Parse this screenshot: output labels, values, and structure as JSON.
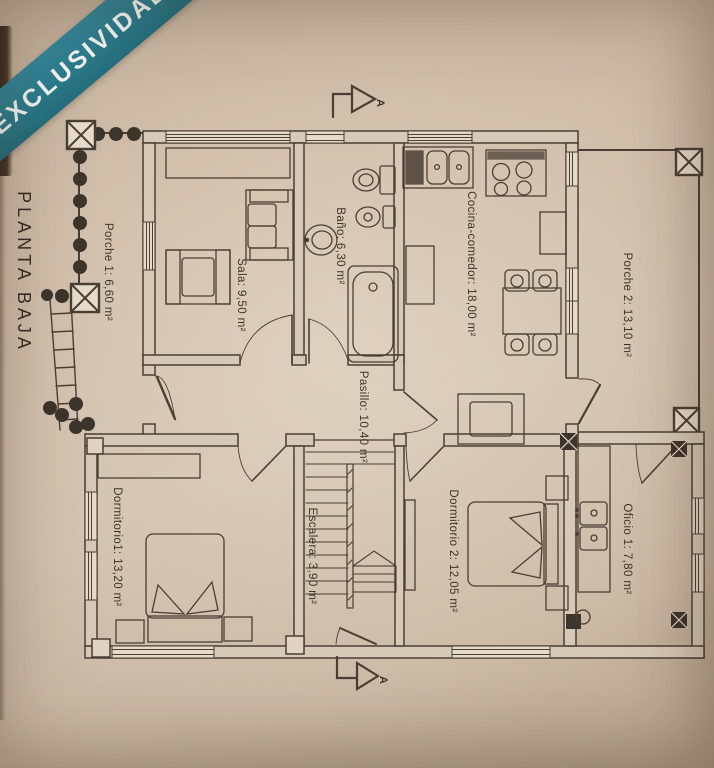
{
  "banner": {
    "label": "EXCLUSIVIDAD"
  },
  "plan": {
    "title": "PLANTA BAJA",
    "section_marker_label": "A",
    "rooms": [
      {
        "id": "porche1",
        "label": "Porche 1: 6,60 m²"
      },
      {
        "id": "sala",
        "label": "Sala: 9,50 m²"
      },
      {
        "id": "bano",
        "label": "Baño: 6,30 m²"
      },
      {
        "id": "cocina",
        "label": "Cocina-comedor: 18,00 m²"
      },
      {
        "id": "porche2",
        "label": "Porche 2: 13,10 m²"
      },
      {
        "id": "pasillo",
        "label": "Pasillo: 10,40 m²"
      },
      {
        "id": "dormitorio1",
        "label": "Dormitorio1: 13,20 m²"
      },
      {
        "id": "escalera",
        "label": "Escalera: 3,90 m²"
      },
      {
        "id": "dormitorio2",
        "label": "Dormitorio 2: 12,05 m²"
      },
      {
        "id": "oficio",
        "label": "Oficio 1: 7,80 m²"
      }
    ],
    "colors": {
      "ribbon_teal": "#2c7d8e",
      "paper_beige": "#cdbca9",
      "line_brown": "#4a3f35"
    }
  }
}
